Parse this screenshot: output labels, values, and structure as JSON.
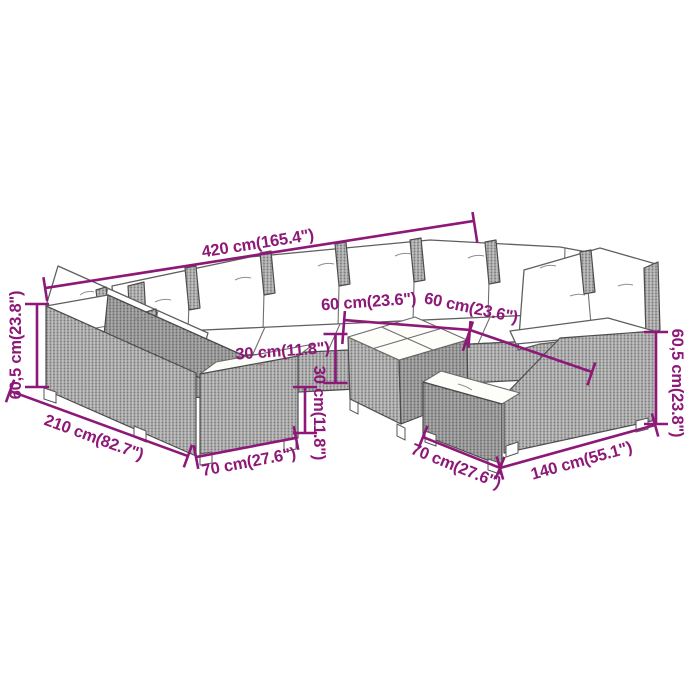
{
  "dimensions": {
    "total_width": "420 cm(165.4\")",
    "left_height": "60,5 cm(23.8\")",
    "right_height": "60,5 cm(23.8\")",
    "total_depth": "210 cm(82.7\")",
    "front_left_module_width": "70 cm(27.6\")",
    "front_right_module_width": "70 cm(27.6\")",
    "right_section_width": "140 cm(55.1\")",
    "table_width": "60 cm(23.6\")",
    "table_depth": "60 cm(23.6\")",
    "table_height": "30 cm(11.8\")",
    "seat_height": "30 cm(11.8\")"
  },
  "colors": {
    "dimension_text": "#8d1878",
    "rattan_gray": "#a9a9a9",
    "cushion_white": "#ffffff",
    "outline_gray": "#4d4d4d",
    "background": "#ffffff"
  }
}
